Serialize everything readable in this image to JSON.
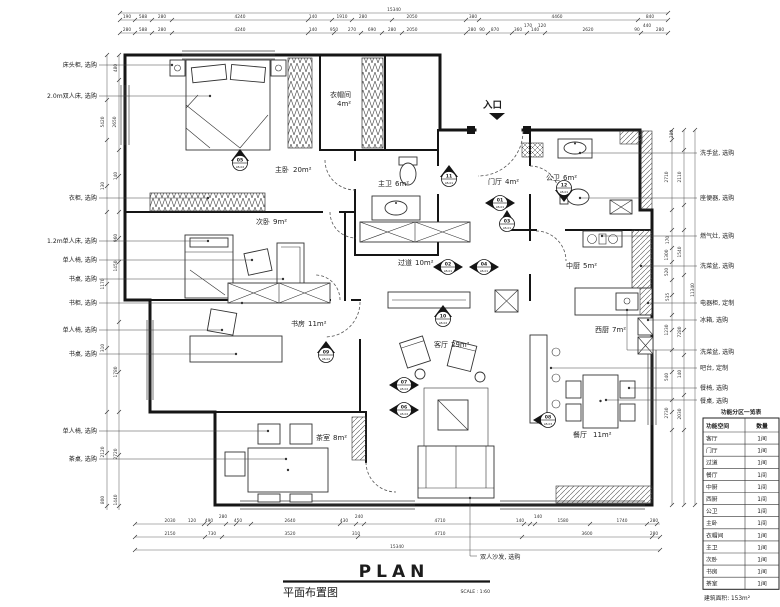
{
  "title_block": {
    "plan": "PLAN",
    "name": "平面布置图",
    "scale": "SCALE : 1:60"
  },
  "entrance_label": "入口",
  "sofa_label": "双人沙发, 选购",
  "rooms": [
    {
      "name": "主卧",
      "area": "20m²"
    },
    {
      "name": "衣帽间",
      "area": "4m²"
    },
    {
      "name": "主卫",
      "area": "6m²"
    },
    {
      "name": "门厅",
      "area": "4m²"
    },
    {
      "name": "公卫",
      "area": "6m²"
    },
    {
      "name": "次卧",
      "area": "9m²"
    },
    {
      "name": "过道",
      "area": "10m²"
    },
    {
      "name": "中厨",
      "area": "5m²"
    },
    {
      "name": "西厨",
      "area": "7m²"
    },
    {
      "name": "书房",
      "area": "11m²"
    },
    {
      "name": "客厅",
      "area": "29m²"
    },
    {
      "name": "茶室",
      "area": "8m²"
    },
    {
      "name": "餐厅",
      "area": "11m²"
    }
  ],
  "left_labels": [
    "床头柜, 选购",
    "2.0m双人床, 选购",
    "衣柜, 选购",
    "1.2m单人床, 选购",
    "单人椅, 选购",
    "书桌, 选购",
    "书柜, 选购",
    "单人椅, 选购",
    "书桌, 选购",
    "单人椅, 选购",
    "茶桌, 选购"
  ],
  "right_labels": [
    "洗手盆, 选购",
    "座便器, 选购",
    "燃气灶, 选购",
    "洗菜盆, 选购",
    "电器柜, 定制",
    "冰箱, 选购",
    "洗菜盆, 选购",
    "吧台, 定制",
    "餐椅, 选购",
    "餐桌, 选购"
  ],
  "markers": [
    {
      "num": "01",
      "code": "LB-01"
    },
    {
      "num": "02",
      "code": "LB-01"
    },
    {
      "num": "03",
      "code": "LB-01"
    },
    {
      "num": "04",
      "code": "LB-01"
    },
    {
      "num": "05",
      "code": "LB-02"
    },
    {
      "num": "06",
      "code": "LB-02"
    },
    {
      "num": "07",
      "code": "LB-02"
    },
    {
      "num": "08",
      "code": "LB-03"
    },
    {
      "num": "09",
      "code": "LB-02"
    },
    {
      "num": "10",
      "code": "LB-02"
    },
    {
      "num": "11",
      "code": "LB-01"
    },
    {
      "num": "12",
      "code": "LB-01"
    }
  ],
  "dims": {
    "top_total": "15340",
    "bottom_total": "15340",
    "top_row1": [
      "190",
      "588",
      "280",
      "4240",
      "140",
      "1910",
      "280",
      "2050",
      "380",
      "4460",
      "840"
    ],
    "top_row2": [
      "280",
      "588",
      "280",
      "4240",
      "140",
      "950",
      "270",
      "690",
      "280",
      "2050",
      "280",
      "90",
      "870",
      "360",
      "170",
      "140",
      "120",
      "2620",
      "90",
      "440",
      "280"
    ],
    "bottom_row1": [
      "2030",
      "120",
      "490",
      "280",
      "450",
      "2640",
      "430",
      "240",
      "4710",
      "140",
      "140",
      "1580",
      "1740",
      "280"
    ],
    "bottom_row2": [
      "2150",
      "730",
      "3520",
      "310",
      "4710",
      "3600",
      "280"
    ],
    "left_col": [
      "480",
      "5420",
      "2650",
      "140",
      "130",
      "960",
      "1450",
      "1170",
      "310",
      "1780",
      "2120",
      "2720",
      "800",
      "1440"
    ],
    "right_col": [
      "280",
      "2710",
      "2110",
      "170",
      "1300",
      "1540",
      "520",
      "535",
      "11340",
      "1230",
      "7280",
      "540",
      "140",
      "2730",
      "2030"
    ]
  },
  "legend_table": {
    "title": "功能分区一览表",
    "headers": [
      "功能空间",
      "数量"
    ],
    "rows": [
      [
        "客厅",
        "1间"
      ],
      [
        "门厅",
        "1间"
      ],
      [
        "过道",
        "1间"
      ],
      [
        "餐厅",
        "1间"
      ],
      [
        "中厨",
        "1间"
      ],
      [
        "西厨",
        "1间"
      ],
      [
        "公卫",
        "1间"
      ],
      [
        "主卧",
        "1间"
      ],
      [
        "衣帽间",
        "1间"
      ],
      [
        "主卫",
        "1间"
      ],
      [
        "次卧",
        "1间"
      ],
      [
        "书房",
        "1间"
      ],
      [
        "茶室",
        "1间"
      ]
    ],
    "footer": "建筑面积: 153m²"
  }
}
